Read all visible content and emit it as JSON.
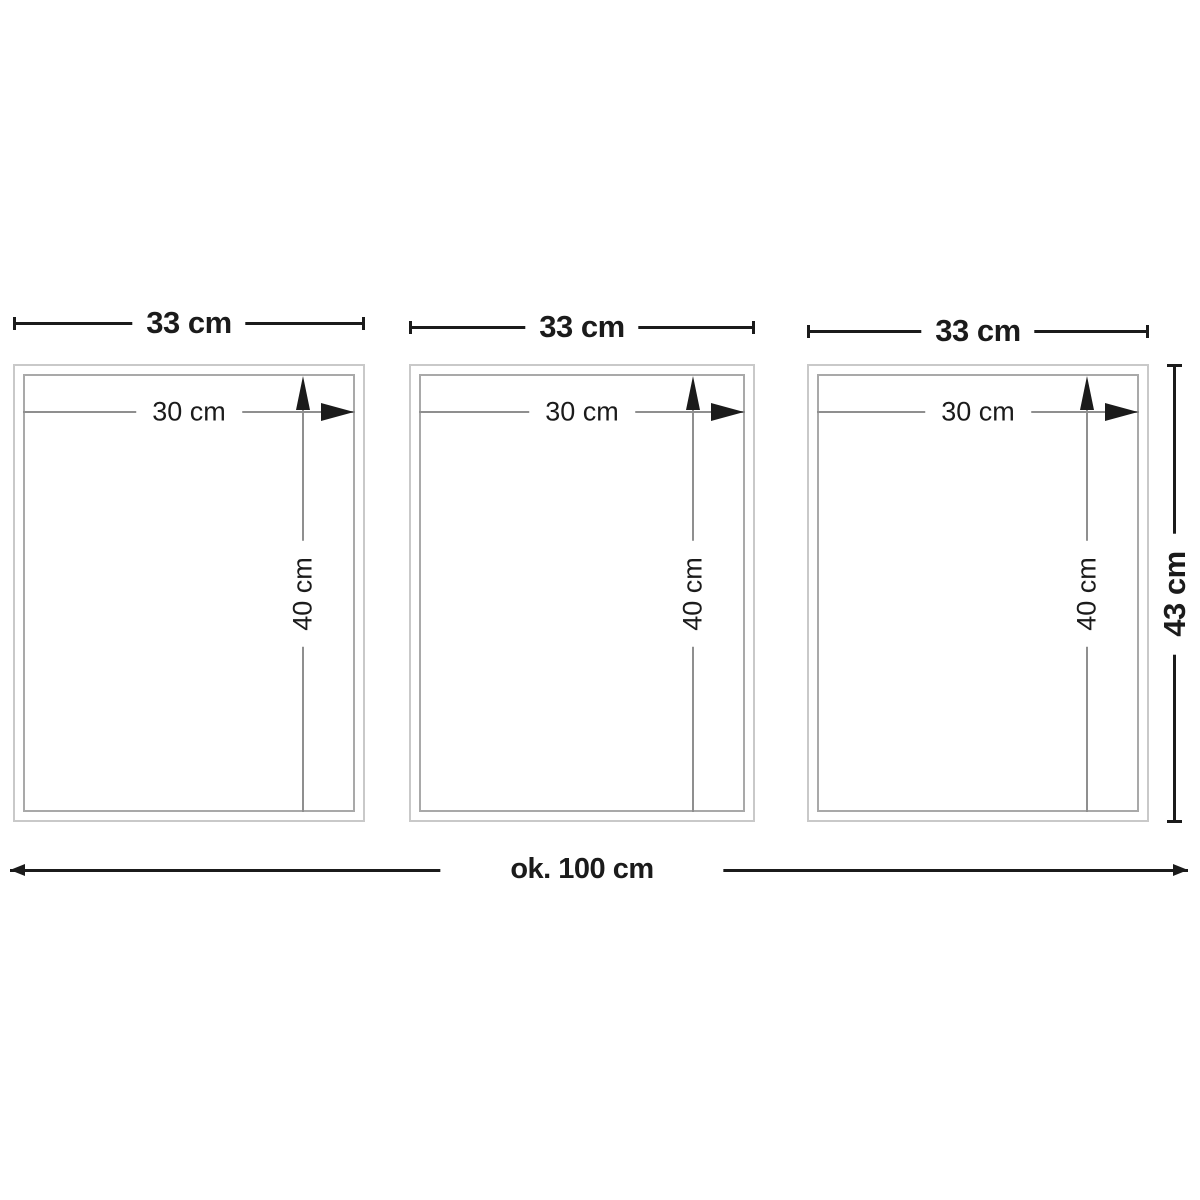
{
  "diagram": {
    "description": "three-panel frame set dimension drawing",
    "frames": [
      {
        "outer_width": "33 cm",
        "inner_width": "30 cm",
        "inner_height": "40 cm"
      },
      {
        "outer_width": "33 cm",
        "inner_width": "30 cm",
        "inner_height": "40 cm"
      },
      {
        "outer_width": "33 cm",
        "inner_width": "30 cm",
        "inner_height": "40 cm"
      }
    ],
    "total_width": "ok. 100 cm",
    "total_height": "43 cm"
  },
  "colors": {
    "dim-dark": "#1b1b1b",
    "dim-gray": "#8f8f8f",
    "frame-outer": "#c9c9c9",
    "frame-inner": "#a9a9a9",
    "bg": "#ffffff"
  }
}
